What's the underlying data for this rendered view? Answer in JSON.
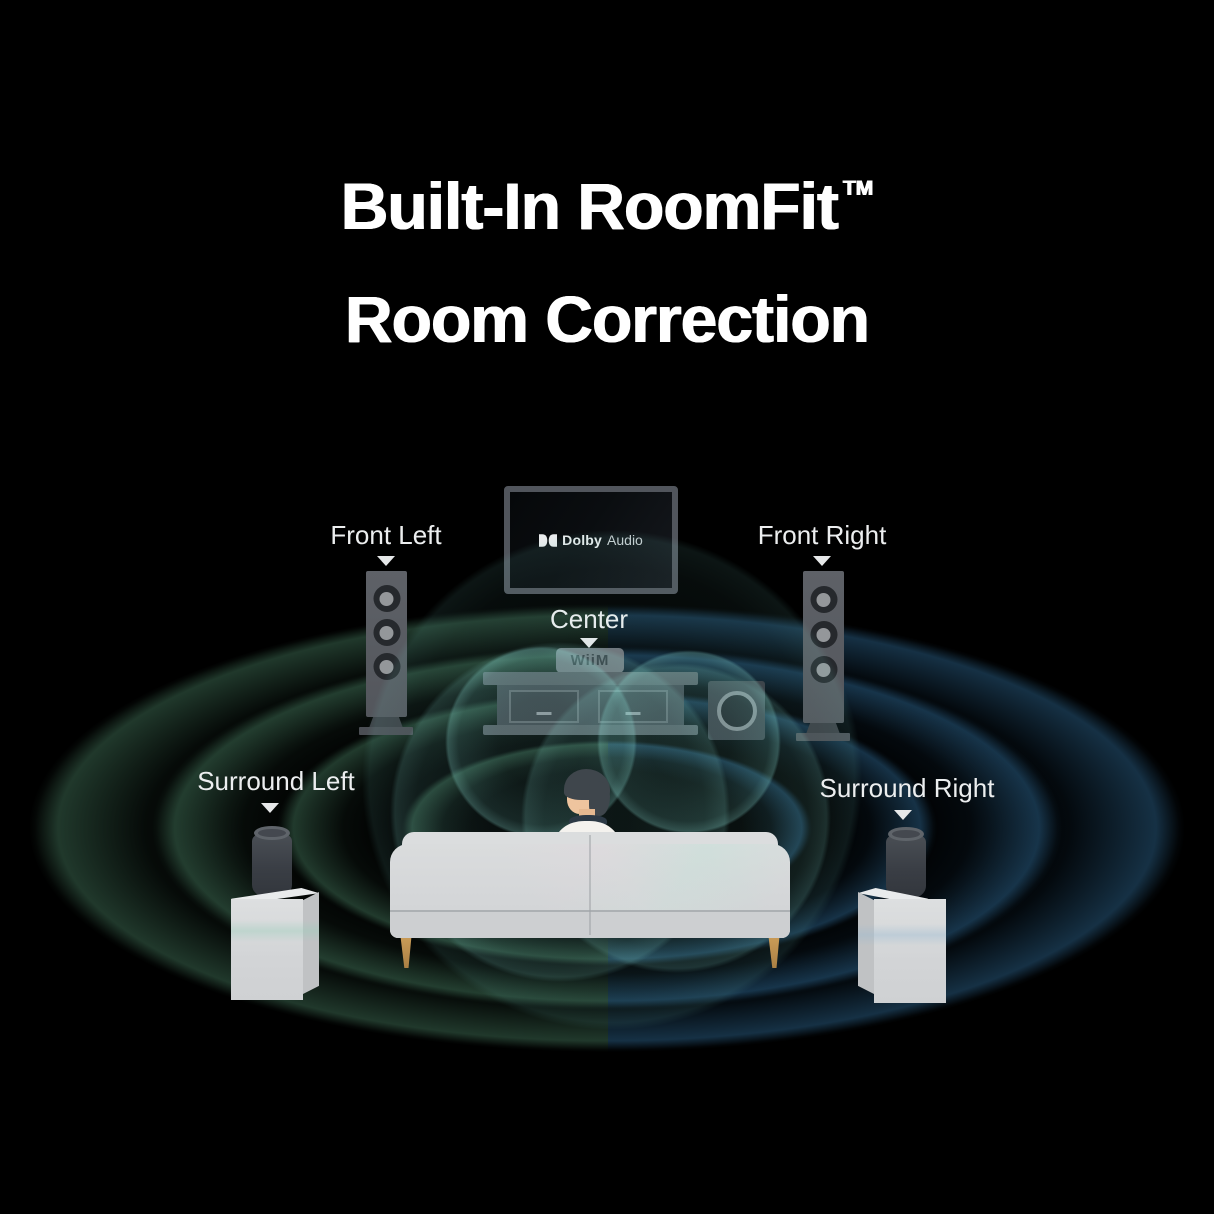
{
  "title": {
    "line1": "Built-In RoomFit",
    "tm": "TM",
    "line2": "Room Correction"
  },
  "tv": {
    "logo_icon": "dolby-double-d-icon",
    "logo_bold": "Dolby",
    "logo_light": "Audio"
  },
  "center_device": {
    "brand": "WiiM"
  },
  "labels": {
    "front_left": "Front Left",
    "front_right": "Front Right",
    "center": "Center",
    "surround_left": "Surround Left",
    "surround_right": "Surround Right"
  },
  "colors": {
    "background": "#000000",
    "title_text": "#ffffff",
    "label_text": "#eceeef",
    "wave_left_green": "#2d5e46",
    "wave_right_blue": "#1d5a83",
    "center_circle_teal": "#8fd9cf",
    "speaker_gray": "#55585e",
    "couch_gray": "#d6d8da",
    "leg_wood": "#b98a4e"
  }
}
